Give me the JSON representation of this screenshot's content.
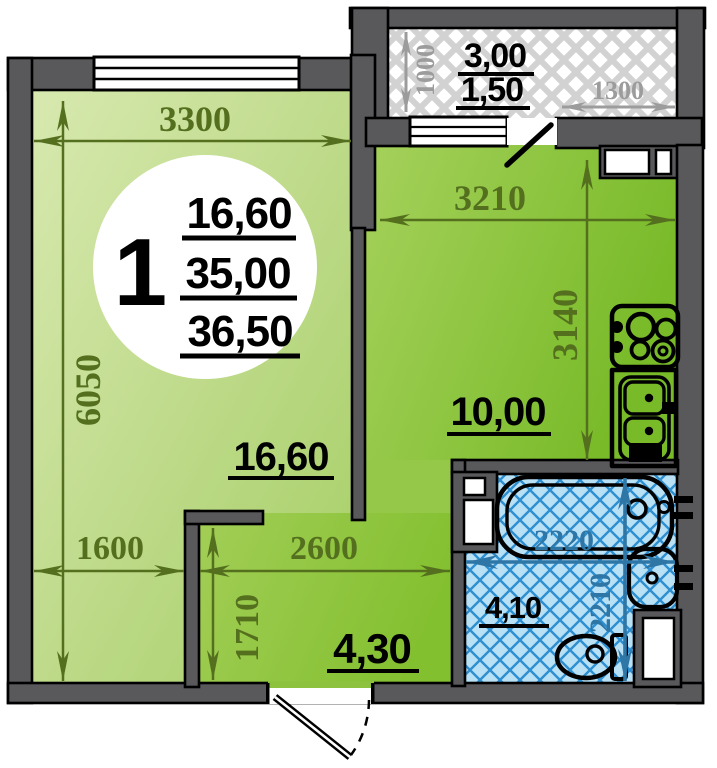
{
  "plan_title": "1-room apartment floor plan",
  "badge": {
    "rooms": "1",
    "living_area": "16,60",
    "total_area": "35,00",
    "overall_area": "36,50"
  },
  "areas": {
    "living": "16,60",
    "kitchen": "10,00",
    "hall": "4,30",
    "bath": "4,10",
    "balcony_full": "3,00",
    "balcony_reduced": "1,50"
  },
  "dims": {
    "living_width": "3300",
    "living_height": "6050",
    "living_bottom_width": "1600",
    "hall_height": "1710",
    "hall_width": "2600",
    "kitchen_width": "3210",
    "kitchen_height": "3140",
    "balcony_depth": "1000",
    "balcony_width": "1300",
    "bath_width": "2220",
    "bath_height": "2210"
  },
  "colors": {
    "wall": "#59595b",
    "living_light": "#d8e9b0",
    "living_dark": "#a6cf64",
    "kitchen_light": "#a6d15c",
    "kitchen_dark": "#78ba28",
    "bath_fill": "#b9e1f6",
    "bath_hatch": "#2e8fd0",
    "balcony_hatch": "#d2d2d2",
    "dim_green": "#54701e",
    "dim_gray": "#9c9c9c",
    "dim_blue": "#2e76a5"
  }
}
